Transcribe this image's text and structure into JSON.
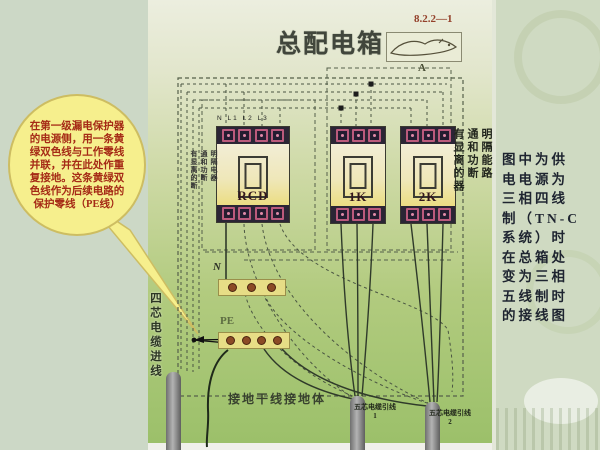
{
  "header": {
    "title": "总配电箱",
    "figure_number": "8.2.2—1",
    "sketch_mark": "A"
  },
  "bubble_lines": [
    "在第一级漏电保护器",
    "的电源侧，用一条黄",
    "绿双色线与工作零线",
    "并联，并在此处作重",
    "复接地。这条黄绿双",
    "色线作为后续电路的",
    "保护零线（PE线）"
  ],
  "side_note_lines": [
    "图中为供",
    "电电源为",
    "三相四线",
    "制（TN-C",
    "系统）时",
    "在总箱处",
    "变为三相",
    "五线制时",
    "的接线图"
  ],
  "devices": [
    {
      "label": "RCD",
      "terminals": 4
    },
    {
      "label": "1K",
      "terminals": 3
    },
    {
      "label": "2K",
      "terminals": 3
    }
  ],
  "terminal_row_label": "N L1 L2 L3",
  "device_note_columns": [
    "有显离的器",
    "通和功断",
    "明隔能路"
  ],
  "device_note_columns_small": [
    "有显离的断",
    "通和功断",
    "明隔电器"
  ],
  "bus_bars": [
    {
      "label": "N",
      "dots": 3
    },
    {
      "label": "PE",
      "dots": 4
    }
  ],
  "incoming_cable_label": "四芯电缆进线",
  "ground_label": "接地干线接地体",
  "outgoing_cables": [
    {
      "label": "五芯电缆引线",
      "number": "1"
    },
    {
      "label": "五芯电缆引线",
      "number": "2"
    }
  ],
  "colors": {
    "panel_green": "#a8c877",
    "left_bg": "#ccd8c6",
    "right_bg": "#cfdac2",
    "bubble_fill": "#f6ef8d",
    "bubble_text": "#a52a16",
    "figure_number_color": "#93402a"
  }
}
